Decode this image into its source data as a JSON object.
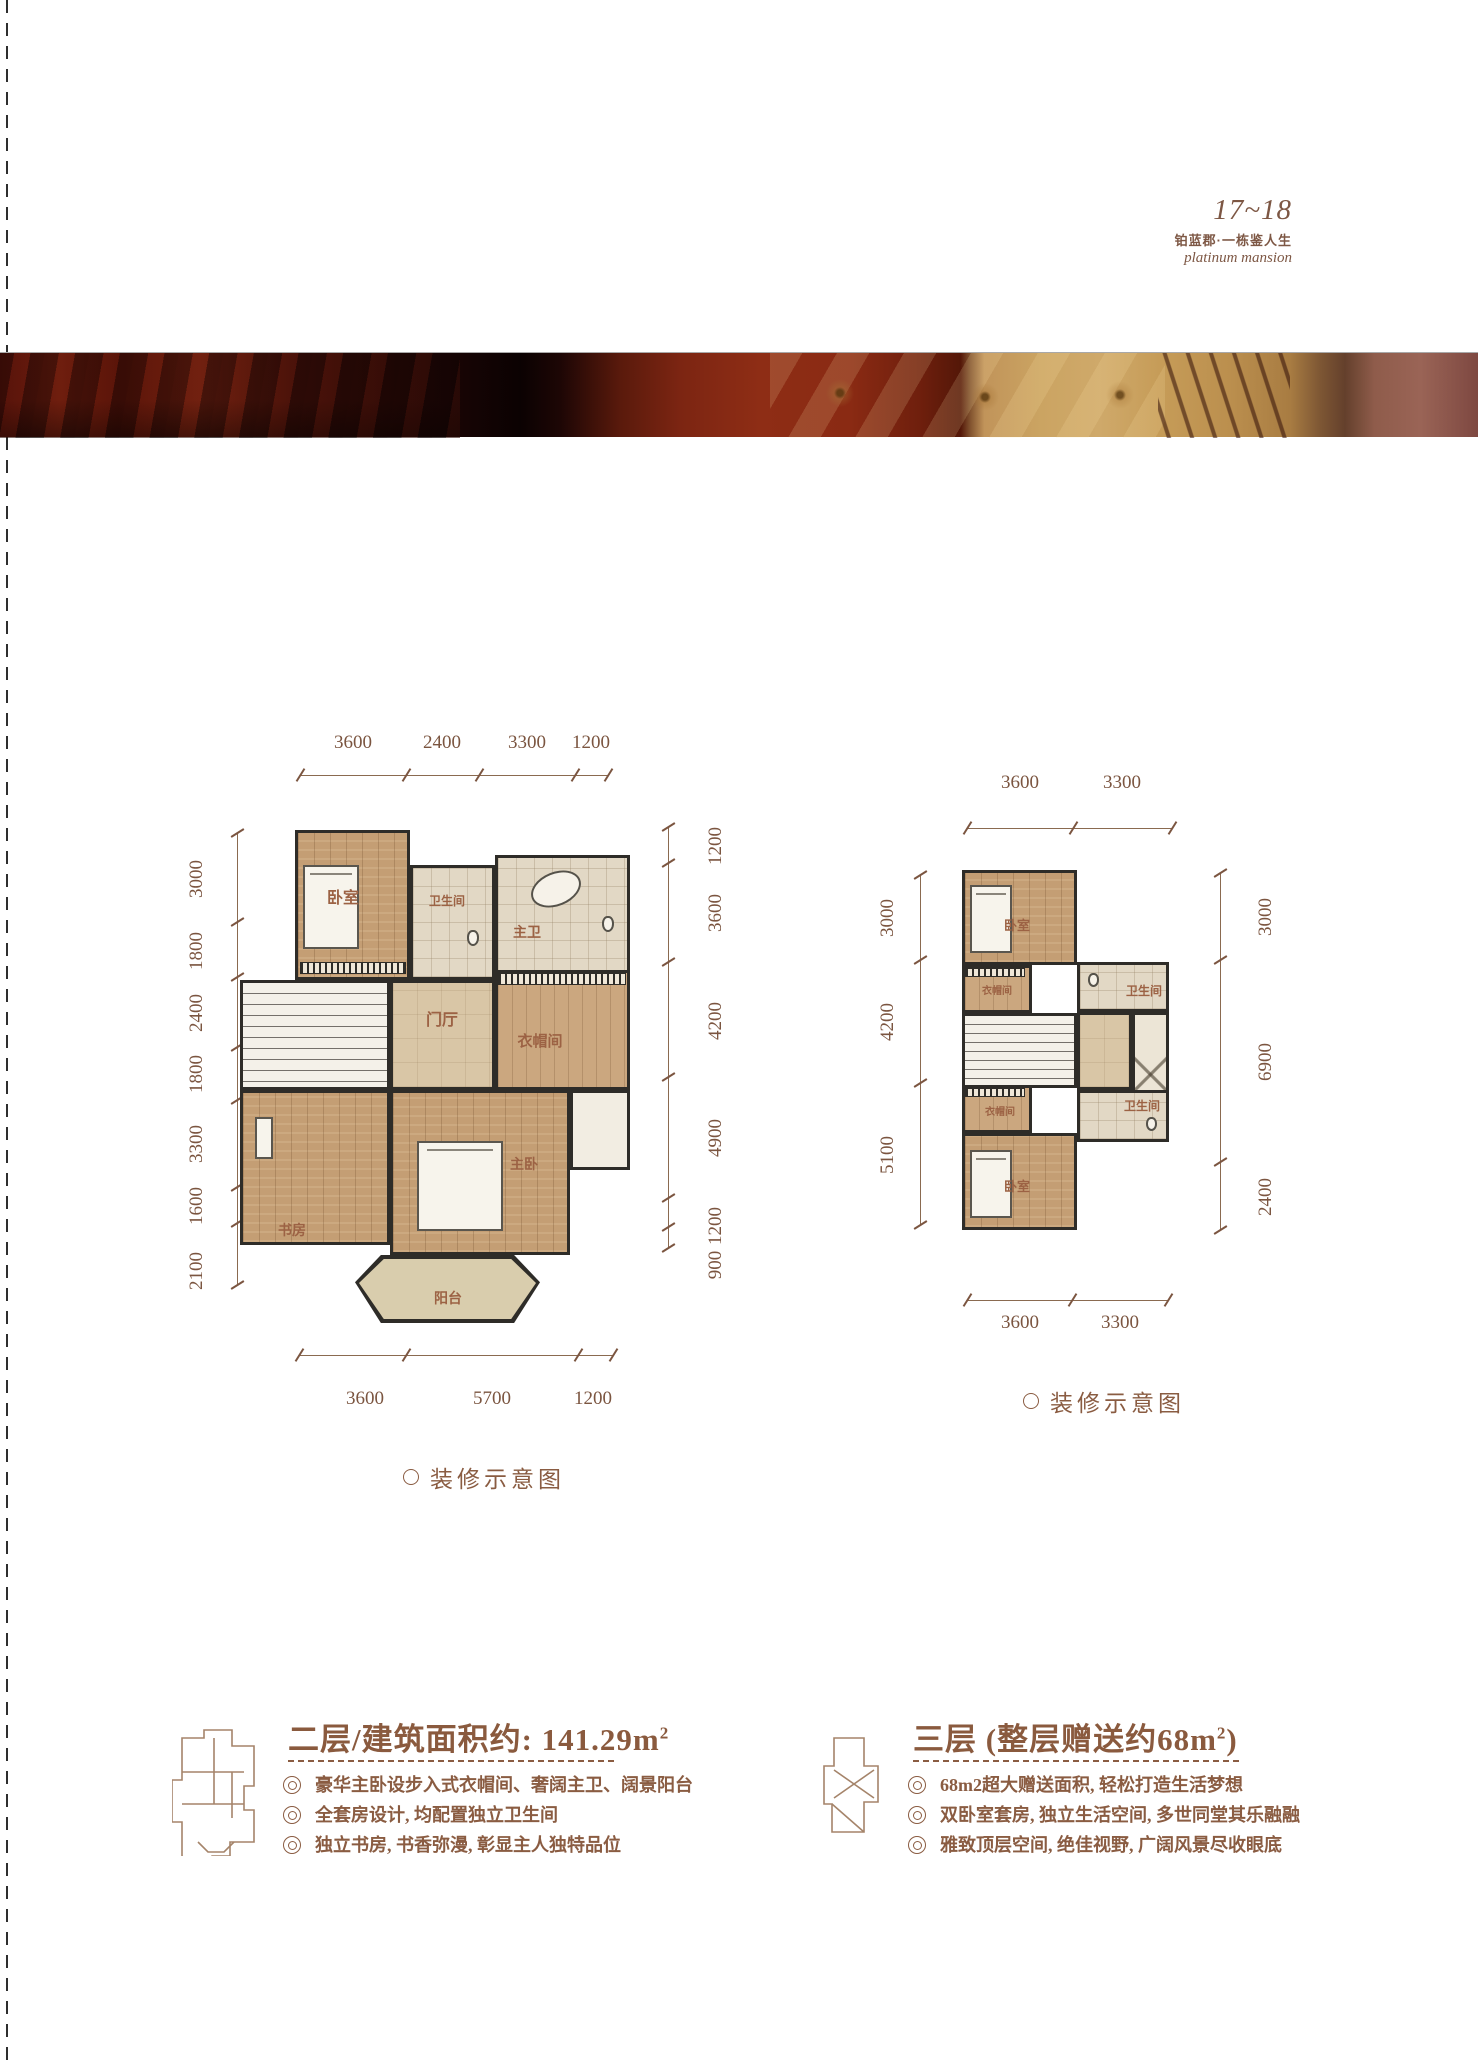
{
  "header": {
    "page_range": "17~18",
    "brand_cn": "铂蓝郡·一栋鉴人生",
    "brand_en": "platinum mansion"
  },
  "colors": {
    "accent_brown": "#8a5c42",
    "dim_brown": "#7b5540",
    "wall_dark": "#2e2c28",
    "hero_red": "#8e2d15",
    "hero_gold": "#cba462"
  },
  "plan2f": {
    "caption": "装修示意图",
    "dims": {
      "top": [
        "3600",
        "2400",
        "3300",
        "1200"
      ],
      "left": [
        "3000",
        "1800",
        "2400",
        "1800",
        "3300",
        "1600",
        "2100"
      ],
      "right": [
        "1200",
        "3600",
        "4200",
        "4900",
        "1200",
        "900"
      ],
      "bottom": [
        "3600",
        "5700",
        "1200"
      ]
    },
    "rooms": {
      "bedroom": "卧室",
      "bath": "卫生间",
      "master_bath": "主卫",
      "foyer": "门厅",
      "closet": "衣帽间",
      "study": "书房",
      "master_bedroom": "主卧",
      "balcony": "阳台"
    }
  },
  "plan3f": {
    "caption": "装修示意图",
    "dims": {
      "top": [
        "3600",
        "3300"
      ],
      "left": [
        "3000",
        "4200",
        "5100"
      ],
      "right": [
        "3000",
        "6900",
        "2400"
      ],
      "bottom": [
        "3600",
        "3300"
      ]
    },
    "rooms": {
      "bedroom_top": "卧室",
      "closet_top": "衣帽间",
      "bath_top": "卫生间",
      "bath_bottom": "卫生间",
      "closet_bottom": "衣帽间",
      "bedroom_bottom": "卧室"
    }
  },
  "info2f": {
    "title_main": "二层/建筑面积约: 141.29m",
    "title_sup": "2",
    "bullets": [
      "豪华主卧设步入式衣帽间、奢阔主卫、阔景阳台",
      "全套房设计, 均配置独立卫生间",
      "独立书房, 书香弥漫, 彰显主人独特品位"
    ]
  },
  "info3f": {
    "title_main": "三层 (整层赠送约68m",
    "title_sup": "2",
    "title_close": ")",
    "bullets": [
      "68m2超大赠送面积, 轻松打造生活梦想",
      "双卧室套房, 独立生活空间, 多世同堂其乐融融",
      "雅致顶层空间, 绝佳视野, 广阔风景尽收眼底"
    ]
  }
}
